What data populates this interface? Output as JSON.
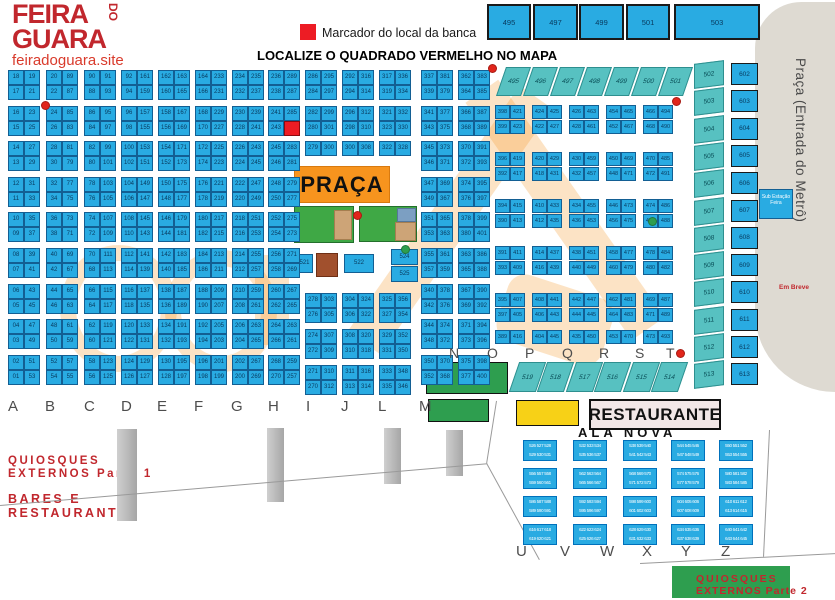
{
  "header": {
    "logo_line1": "FEIRA",
    "logo_do": "DO",
    "logo_line2": "GUARA",
    "site": "feiradoguara.site",
    "legend": "Marcador do local da banca",
    "title": "LOCALIZE O QUADRADO VERMELHO NO MAPA"
  },
  "colors": {
    "cell_blue": "#29ABE2",
    "teal": "#57C1C1",
    "marker_red": "#ED1C24",
    "praca_orange": "#F7941E",
    "map_green": "#2E9E4F",
    "yellow": "#F7D117",
    "brand_red": "#C1272D",
    "metro_gray": "#DEDAD2"
  },
  "top_row": [
    "495",
    "497",
    "499",
    "501",
    "503"
  ],
  "diag_top": [
    "495",
    "496",
    "497",
    "498",
    "499",
    "500",
    "501"
  ],
  "diag_bottom": [
    "519",
    "518",
    "517",
    "516",
    "515",
    "514"
  ],
  "right_area": {
    "metro_label": "Praça (Entrada do Metrô)",
    "em_breve": "Em Breve",
    "sub_station": "Sub Estação Feira",
    "teal_column": [
      "502",
      "503",
      "504",
      "505",
      "506",
      "507",
      "508",
      "509",
      "510",
      "511",
      "512",
      "513"
    ],
    "blue_column": [
      "602",
      "603",
      "604",
      "605",
      "606",
      "607",
      "608",
      "609",
      "610",
      "611",
      "612",
      "613"
    ]
  },
  "praca": {
    "label": "PRAÇA",
    "c521": "521",
    "c522": "522",
    "c524": "524",
    "c525": "525"
  },
  "letters_bottom": [
    "A",
    "B",
    "C",
    "D",
    "E",
    "F",
    "G",
    "H",
    "I",
    "J",
    "L",
    "M"
  ],
  "letters_mid": [
    "N",
    "O",
    "P",
    "Q",
    "R",
    "S",
    "T"
  ],
  "letters_south": [
    "U",
    "V",
    "W",
    "X",
    "Y",
    "Z"
  ],
  "south": {
    "quiosques1a": "QUIOSQUES",
    "quiosques1b": "EXTERNOS Parte 1",
    "bares1": "BARES E",
    "bares2": "RESTAURANTES",
    "restaurante": "RESTAURANTE",
    "ala_nova": "ALA NOVA",
    "quiosques2a": "QUIOSQUES",
    "quiosques2b": "EXTERNOS Parte 2"
  },
  "grids": {
    "A": [
      "18|19",
      "17|21",
      "16|23",
      "15|25",
      "14|27",
      "13|29",
      "12|31",
      "11|33",
      "10|35",
      "09|37",
      "08|39",
      "07|41",
      "06|43",
      "05|45",
      "04|47",
      "03|49",
      "02|51",
      "01|53"
    ],
    "B": [
      "20|89",
      "22|87",
      "24|85",
      "26|83",
      "28|81",
      "30|79",
      "32|77",
      "34|75",
      "36|73",
      "38|71",
      "40|69",
      "42|67",
      "44|65",
      "46|63",
      "48|61",
      "50|59",
      "52|57",
      "54|55"
    ],
    "C": [
      "90|91",
      "88|93",
      "86|95",
      "84|97",
      "82|99",
      "80|101",
      "78|103",
      "76|105",
      "74|107",
      "72|109",
      "70|111",
      "68|113",
      "66|115",
      "64|117",
      "62|119",
      "60|121",
      "58|123",
      "56|125"
    ],
    "D": [
      "92|161",
      "94|159",
      "96|157",
      "98|155",
      "100|153",
      "102|151",
      "104|149",
      "106|147",
      "108|145",
      "110|143",
      "112|141",
      "114|139",
      "116|137",
      "118|135",
      "120|133",
      "122|131",
      "124|129",
      "126|127"
    ],
    "E": [
      "162|163",
      "160|165",
      "158|167",
      "156|169",
      "154|171",
      "152|173",
      "150|175",
      "148|177",
      "146|179",
      "144|181",
      "142|183",
      "140|185",
      "138|187",
      "136|189",
      "134|191",
      "132|193",
      "130|195",
      "128|197"
    ],
    "F": [
      "164|233",
      "166|231",
      "168|229",
      "170|227",
      "172|225",
      "174|223",
      "176|221",
      "178|219",
      "180|217",
      "182|215",
      "184|213",
      "186|211",
      "188|209",
      "190|207",
      "192|205",
      "194|203",
      "196|201",
      "198|199"
    ],
    "G": [
      "234|235",
      "232|237",
      "230|239",
      "228|241",
      "226|243",
      "224|245",
      "222|247",
      "220|249",
      "218|251",
      "216|253",
      "214|255",
      "212|257",
      "210|259",
      "208|261",
      "206|263",
      "204|265",
      "202|267",
      "200|269"
    ],
    "H": [
      "236|289",
      "238|287",
      "241|285",
      "243|*",
      "245|283",
      "246|281",
      "248|279",
      "250|277",
      "252|275",
      "254|273",
      "256|271",
      "258|269",
      "260|267",
      "262|265",
      "264|263",
      "266|261",
      "268|259",
      "270|257"
    ],
    "M": [
      "337|381",
      "339|379",
      "341|377",
      "343|375",
      "345|373",
      "346|371",
      "347|369",
      "349|367",
      "351|365",
      "353|363",
      "355|361",
      "357|359",
      "340|378",
      "342|376",
      "344|374",
      "348|372",
      "350|370",
      "352|368"
    ],
    "M2": [
      "362|383",
      "364|385",
      "366|387",
      "368|389",
      "370|391",
      "372|393",
      "374|395",
      "376|397",
      "378|399",
      "380|401",
      "363|386",
      "365|388",
      "367|390",
      "369|392",
      "371|394",
      "373|396",
      "375|398",
      "377|400"
    ],
    "Itop": [
      "286|295",
      "284|297",
      "282|299",
      "280|301",
      "279|300"
    ],
    "Jtop": [
      "292|316",
      "294|314",
      "296|312",
      "298|310",
      "300|308"
    ],
    "Ltop": [
      "317|336",
      "319|334",
      "321|332",
      "323|330",
      "322|328"
    ],
    "Ibot": [
      "278|303",
      "276|305",
      "274|307",
      "272|309",
      "271|310",
      "270|312"
    ],
    "Jbot": [
      "304|324",
      "306|322",
      "308|320",
      "310|318",
      "311|316",
      "313|314"
    ],
    "Lbot": [
      "325|356",
      "327|354",
      "329|352",
      "331|350",
      "333|348",
      "335|346"
    ],
    "N1": [
      "398|421",
      "399|423",
      "396|419",
      "392|417",
      "394|415",
      "390|413",
      "391|411",
      "393|409",
      "395|407",
      "397|405",
      "389|416"
    ],
    "N2": [
      "424|425",
      "422|427",
      "420|429",
      "418|431",
      "410|433",
      "412|435",
      "414|437",
      "416|439",
      "408|441",
      "406|443",
      "404|445"
    ],
    "N3": [
      "426|463",
      "428|461",
      "430|459",
      "432|457",
      "434|455",
      "436|453",
      "438|451",
      "440|449",
      "442|447",
      "444|445",
      "435|450"
    ],
    "N4": [
      "454|465",
      "452|467",
      "450|469",
      "448|471",
      "446|473",
      "456|475",
      "458|477",
      "460|479",
      "462|481",
      "464|483",
      "453|470"
    ],
    "N5": [
      "466|494",
      "468|490",
      "470|485",
      "472|491",
      "474|486",
      "476|488",
      "478|484",
      "480|482",
      "469|487",
      "471|489",
      "473|493"
    ]
  },
  "ala_nova_blocks": [
    "526 527 528|529 530 531",
    "532 533 534|535 536 537",
    "538 539 540|541 542 543",
    "544 545 546|547 548 549",
    "550 551 552|553 554 555",
    "556 557 558|559 560 561",
    "562 563 564|565 566 567",
    "568 569 570|571 572 573",
    "574 575 576|577 578 579",
    "580 581 582|583 584 585",
    "586 587 588|589 590 591",
    "592 593 594|595 596 597",
    "598 599 600|601 602 603",
    "604 605 606|607 608 609",
    "610 611 612|613 614 615",
    "616 617 618|619 620 621",
    "622 623 624|625 626 627",
    "628 629 630|631 632 633",
    "634 635 636|637 638 639",
    "640 641 642|643 644 645"
  ]
}
